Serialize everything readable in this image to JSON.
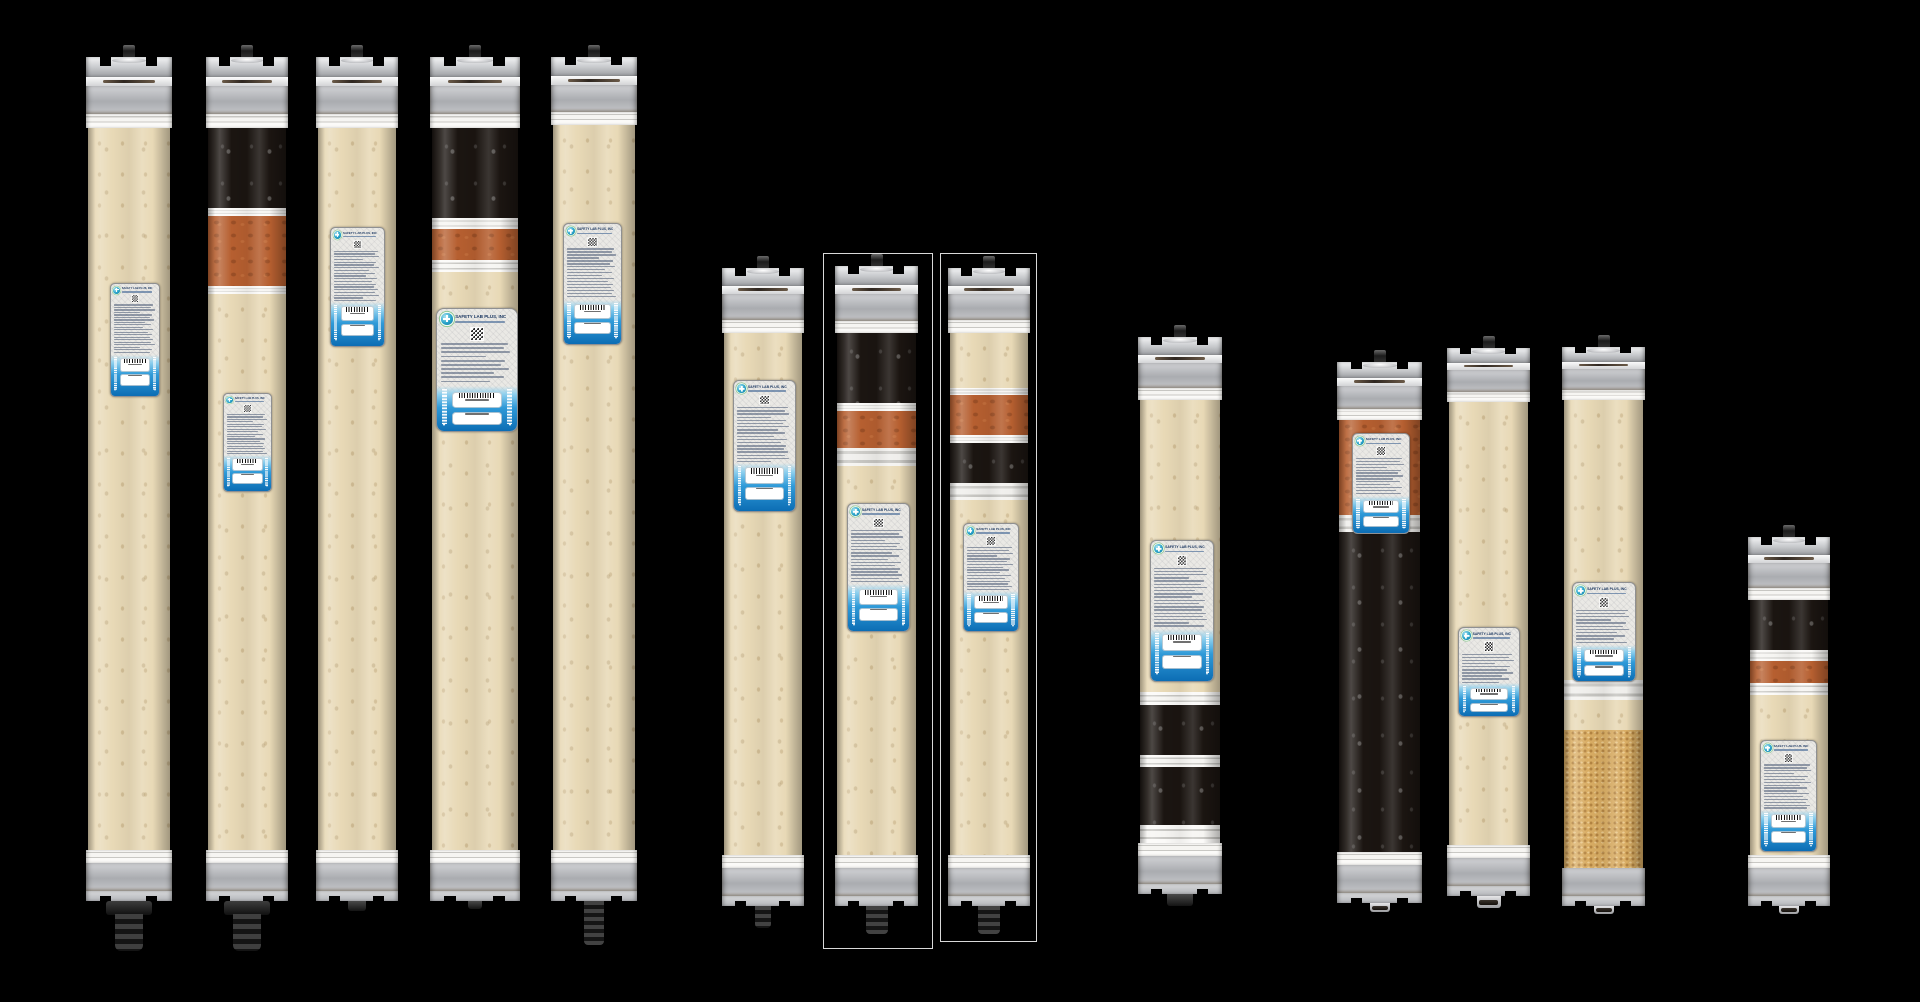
{
  "label": {
    "brand": "SAFETY LAB PLUS, INC"
  },
  "colors": {
    "background": "#000000",
    "resin_tan": "#e8d9b6",
    "resin_black": "#1b1511",
    "resin_orange": "#b65f30",
    "resin_granular": "#d9ad64",
    "label_bg": "#eae9e5",
    "label_blue_deep": "#0c6db4",
    "brand_text": "#16335e",
    "logo_teal": "#27a3c9",
    "outline": "#f5f5f5"
  },
  "cartridges": [
    {
      "id": "c1",
      "x": 86,
      "w": 86,
      "cap_top": 57,
      "body_top": 128,
      "segments": [
        {
          "t": "tan",
          "h": 722
        }
      ],
      "bottom_stripe": true,
      "stem": {
        "kind": "plug",
        "w": 46,
        "h": 50
      },
      "label_box": {
        "x": 110,
        "y": 283,
        "w": 48,
        "h": 112
      },
      "outline": null
    },
    {
      "id": "c2",
      "x": 206,
      "w": 82,
      "cap_top": 57,
      "body_top": 128,
      "segments": [
        {
          "t": "black",
          "h": 80
        },
        {
          "t": "band",
          "h": 8
        },
        {
          "t": "orange",
          "h": 70
        },
        {
          "t": "band",
          "h": 8
        },
        {
          "t": "tan",
          "h": 556
        }
      ],
      "bottom_stripe": true,
      "stem": {
        "kind": "plug",
        "w": 46,
        "h": 50
      },
      "label_box": {
        "x": 223,
        "y": 393,
        "w": 47,
        "h": 97
      },
      "outline": null
    },
    {
      "id": "c3",
      "x": 316,
      "w": 82,
      "cap_top": 57,
      "body_top": 128,
      "segments": [
        {
          "t": "tan",
          "h": 722
        }
      ],
      "bottom_stripe": true,
      "stem": {
        "kind": "nub",
        "w": 18,
        "h": 10
      },
      "label_box": {
        "x": 330,
        "y": 227,
        "w": 53,
        "h": 118
      },
      "outline": null
    },
    {
      "id": "c4",
      "x": 430,
      "w": 90,
      "cap_top": 57,
      "body_top": 128,
      "segments": [
        {
          "t": "black",
          "h": 90
        },
        {
          "t": "band",
          "h": 11
        },
        {
          "t": "orange",
          "h": 31
        },
        {
          "t": "band",
          "h": 12
        },
        {
          "t": "tan",
          "h": 578
        }
      ],
      "bottom_stripe": true,
      "stem": {
        "kind": "nub",
        "w": 14,
        "h": 8
      },
      "label_box": {
        "x": 436,
        "y": 308,
        "w": 80,
        "h": 122
      },
      "outline": null
    },
    {
      "id": "c5",
      "x": 551,
      "w": 86,
      "cap_top": 57,
      "body_top": 125,
      "segments": [
        {
          "t": "tan",
          "h": 725
        }
      ],
      "bottom_stripe": true,
      "stem": {
        "kind": "rib",
        "w": 20,
        "h": 44
      },
      "label_box": {
        "x": 563,
        "y": 223,
        "w": 57,
        "h": 120
      },
      "outline": null
    },
    {
      "id": "c6",
      "x": 722,
      "w": 82,
      "cap_top": 268,
      "body_top": 333,
      "segments": [
        {
          "t": "tan",
          "h": 522
        }
      ],
      "bottom_stripe": true,
      "stem": {
        "kind": "rib",
        "w": 16,
        "h": 22
      },
      "label_box": {
        "x": 733,
        "y": 380,
        "w": 61,
        "h": 130
      },
      "outline": null
    },
    {
      "id": "c7",
      "x": 835,
      "w": 83,
      "cap_top": 266,
      "body_top": 333,
      "segments": [
        {
          "t": "black",
          "h": 70
        },
        {
          "t": "band",
          "h": 8
        },
        {
          "t": "orange",
          "h": 37
        },
        {
          "t": "metalband",
          "h": 18
        },
        {
          "t": "tan",
          "h": 389
        }
      ],
      "bottom_stripe": true,
      "stem": {
        "kind": "rib",
        "w": 22,
        "h": 28
      },
      "label_box": {
        "x": 847,
        "y": 503,
        "w": 61,
        "h": 127
      },
      "outline": {
        "x": 823,
        "y": 253,
        "w": 108,
        "h": 694
      }
    },
    {
      "id": "c8",
      "x": 948,
      "w": 82,
      "cap_top": 268,
      "body_top": 333,
      "segments": [
        {
          "t": "tan",
          "h": 55
        },
        {
          "t": "band",
          "h": 7
        },
        {
          "t": "orange",
          "h": 40
        },
        {
          "t": "band",
          "h": 8
        },
        {
          "t": "black",
          "h": 40
        },
        {
          "t": "metalband",
          "h": 17
        },
        {
          "t": "tan",
          "h": 355
        }
      ],
      "bottom_stripe": true,
      "stem": {
        "kind": "rib",
        "w": 22,
        "h": 28
      },
      "label_box": {
        "x": 963,
        "y": 523,
        "w": 54,
        "h": 107
      },
      "outline": {
        "x": 940,
        "y": 253,
        "w": 95,
        "h": 687
      }
    },
    {
      "id": "c9",
      "x": 1138,
      "w": 84,
      "cap_top": 337,
      "body_top": 400,
      "segments": [
        {
          "t": "tan",
          "h": 292
        },
        {
          "t": "band",
          "h": 13
        },
        {
          "t": "black",
          "h": 50
        },
        {
          "t": "band",
          "h": 12
        },
        {
          "t": "black",
          "h": 58
        },
        {
          "t": "band",
          "h": 18
        }
      ],
      "bottom_stripe": true,
      "stem": {
        "kind": "nub",
        "w": 26,
        "h": 12
      },
      "label_box": {
        "x": 1150,
        "y": 540,
        "w": 62,
        "h": 140
      },
      "outline": null
    },
    {
      "id": "c10",
      "x": 1337,
      "w": 85,
      "cap_top": 362,
      "body_top": 420,
      "segments": [
        {
          "t": "orange",
          "h": 95
        },
        {
          "t": "metalband",
          "h": 17
        },
        {
          "t": "black",
          "h": 320
        }
      ],
      "bottom_stripe": true,
      "stem": {
        "kind": "nub-metal",
        "w": 20,
        "h": 9
      },
      "label_box": {
        "x": 1352,
        "y": 433,
        "w": 56,
        "h": 99
      },
      "outline": null
    },
    {
      "id": "c11",
      "x": 1447,
      "w": 83,
      "cap_top": 348,
      "body_top": 402,
      "segments": [
        {
          "t": "tan",
          "h": 443
        }
      ],
      "bottom_stripe": true,
      "stem": {
        "kind": "nub-metal",
        "w": 24,
        "h": 12
      },
      "label_box": {
        "x": 1458,
        "y": 627,
        "w": 60,
        "h": 88
      },
      "outline": null
    },
    {
      "id": "c12",
      "x": 1562,
      "w": 83,
      "cap_top": 347,
      "body_top": 400,
      "segments": [
        {
          "t": "tan",
          "h": 280
        },
        {
          "t": "metalband",
          "h": 20
        },
        {
          "t": "tan",
          "h": 30
        },
        {
          "t": "gran",
          "h": 138
        }
      ],
      "bottom_stripe": false,
      "stem": {
        "kind": "nub-metal",
        "w": 20,
        "h": 8
      },
      "label_box": {
        "x": 1572,
        "y": 582,
        "w": 62,
        "h": 98
      },
      "outline": null
    },
    {
      "id": "c13",
      "x": 1748,
      "w": 82,
      "cap_top": 537,
      "body_top": 600,
      "segments": [
        {
          "t": "black",
          "h": 50
        },
        {
          "t": "band",
          "h": 11
        },
        {
          "t": "orange",
          "h": 22
        },
        {
          "t": "band",
          "h": 12
        },
        {
          "t": "tan",
          "h": 160
        }
      ],
      "bottom_stripe": true,
      "stem": {
        "kind": "nub-metal",
        "w": 20,
        "h": 8
      },
      "label_box": {
        "x": 1760,
        "y": 740,
        "w": 55,
        "h": 110
      },
      "outline": null
    }
  ]
}
